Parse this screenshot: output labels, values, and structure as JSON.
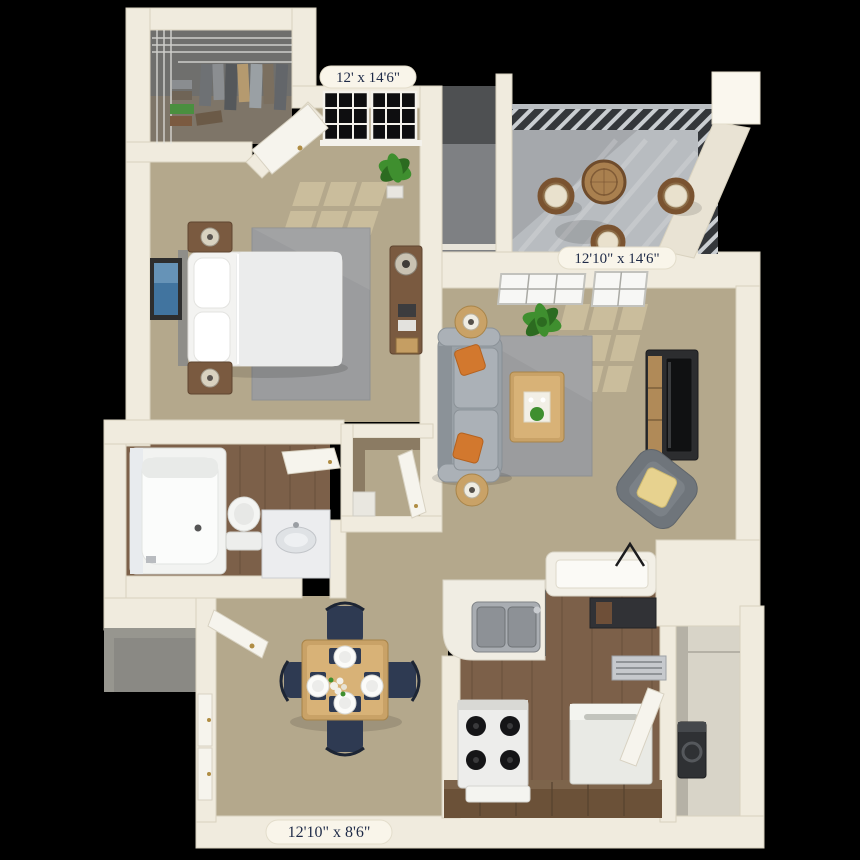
{
  "floorplan": {
    "style": "3D rendered apartment floor plan, top-down view on black background",
    "rooms": [
      "walk-in-closet",
      "bedroom",
      "entry-alcove",
      "balcony",
      "living-room",
      "bathroom",
      "hall-closet",
      "entry",
      "dining-area",
      "kitchen",
      "laundry-storage"
    ],
    "dimension_labels": [
      {
        "room": "bedroom",
        "text": "12' x 14'6\""
      },
      {
        "room": "living-room",
        "text": "12'10\" x 14'6\""
      },
      {
        "room": "dining-kitchen",
        "text": "12'10\" x 8'6\""
      }
    ]
  },
  "labels": {
    "bedroom_dim": "12' x 14'6\"",
    "living_dim": "12'10\" x 14'6\"",
    "dining_dim": "12'10\" x 8'6\""
  },
  "palette": {
    "bg": "#000000",
    "wall": "#f0ebde",
    "wallEdge": "#d9d2bf",
    "wallBright": "#faf7ee",
    "carpet": "#b4a88c",
    "carpetLight": "#d2c4a2",
    "rug": "#9b9c9e",
    "woodFloor": "#7c6049",
    "woodDark": "#5e4936",
    "cabinet": "#6b5138",
    "cabinetTop": "#7d644b",
    "balconyFloor": "#b8bcc0",
    "rail": "#34373b",
    "railLight": "#caced2",
    "offWhite": "#f6f4ed",
    "steel": "#a9adb2",
    "steelDark": "#8d9196",
    "sofa": "#9aa1a7",
    "sofaLight": "#abb1b7",
    "orange": "#d2782e",
    "orangeDark": "#b5621f",
    "armchair": "#6f757b",
    "yellow": "#e7d28f",
    "navy": "#2e3a52",
    "tableWood": "#c9a267",
    "tableWoodLight": "#d8b277",
    "brownWood": "#7a5a40",
    "plant": "#3f8f2f",
    "plantDark": "#2c6b20",
    "alcoveDark": "#4e5052",
    "alcoveMid": "#7e8083",
    "closetGray": "#6f6f6d",
    "laundryFloor": "#d8d4c8",
    "artBlue": "#41749f",
    "tile": "#e8ebee",
    "labelBg": "#f9f5ea",
    "labelInk": "#1e2a47"
  }
}
